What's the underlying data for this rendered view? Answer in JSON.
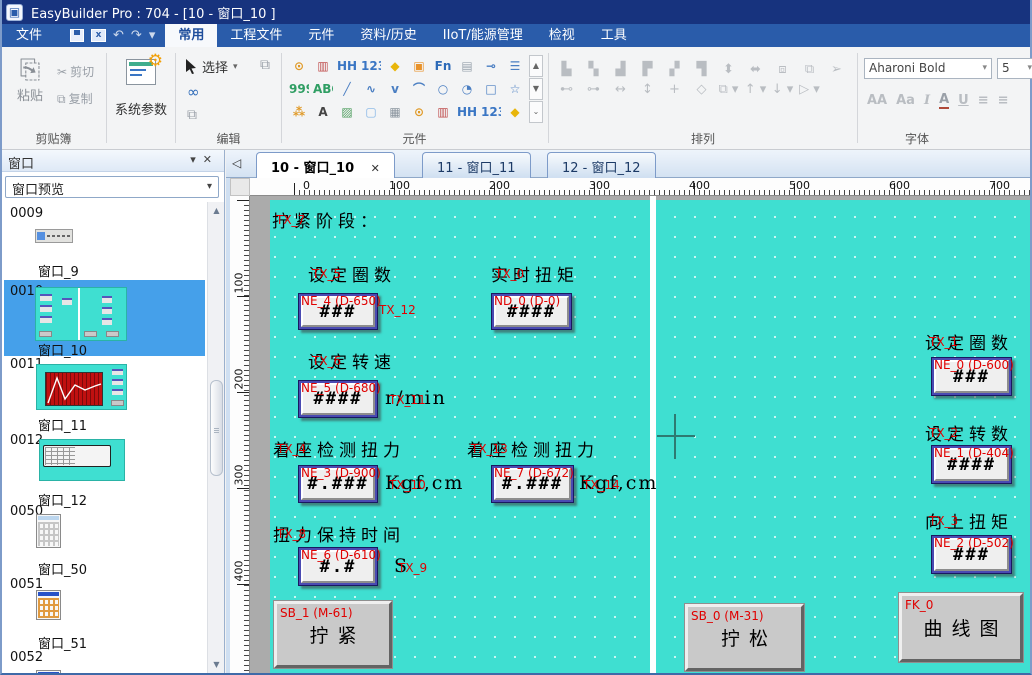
{
  "title_bar": {
    "title": "EasyBuilder Pro : 704 - [10 - 窗口_10 ]"
  },
  "menu_bar": {
    "file": "文件",
    "quick": {
      "undo": "↶",
      "redo": "↷",
      "more": "▾",
      "export_label": "x"
    },
    "tabs": [
      {
        "label": "常用"
      },
      {
        "label": "工程文件"
      },
      {
        "label": "元件"
      },
      {
        "label": "资料/历史"
      },
      {
        "label": "IIoT/能源管理"
      },
      {
        "label": "检视"
      },
      {
        "label": "工具"
      }
    ]
  },
  "ribbon": {
    "clipboard": {
      "paste": "粘贴",
      "cut": "剪切",
      "copy": "复制",
      "label": "剪贴簿",
      "paste_glyph": "⎘",
      "cut_glyph": "✂",
      "copy_glyph": "⧉"
    },
    "system_params": {
      "label": "系统参数",
      "gear_glyph": "⚙"
    },
    "edit": {
      "select": "选择",
      "label": "编辑",
      "caret": "▾",
      "infinity": "∞",
      "dup": "⧉",
      "win": "⧉"
    },
    "components": {
      "label": "元件",
      "scroll": {
        "up": "▲",
        "down": "▼",
        "more": "⌄"
      },
      "icons": [
        {
          "name": "bit-lamp-icon",
          "g": "⊙",
          "c": "#e09a28"
        },
        {
          "name": "word-lamp-icon",
          "g": "▥",
          "c": "#c05050"
        },
        {
          "name": "set-bit-icon",
          "g": "HH",
          "c": "#3a76c4"
        },
        {
          "name": "set-word-icon",
          "g": "123",
          "c": "#3a76c4"
        },
        {
          "name": "function-key-icon",
          "g": "◆",
          "c": "#e8b50a"
        },
        {
          "name": "toggle-switch-icon",
          "g": "▣",
          "c": "#e8922a"
        },
        {
          "name": "fn-key-icon",
          "g": "Fn",
          "c": "#2d6ab8"
        },
        {
          "name": "multi-state-icon",
          "g": "▤",
          "c": "#9aa4ae"
        },
        {
          "name": "slider-icon",
          "g": "⊸",
          "c": "#4a7ec2"
        },
        {
          "name": "option-list-icon",
          "g": "☰",
          "c": "#4a7ec2"
        },
        {
          "name": "numeric-999-icon",
          "g": "999",
          "c": "#2f9e63"
        },
        {
          "name": "ascii-abc-icon",
          "g": "ABC",
          "c": "#2f9e63"
        },
        {
          "name": "line-icon",
          "g": "╱",
          "c": "#4a7ec2"
        },
        {
          "name": "wave-icon",
          "g": "∿",
          "c": "#4a7ec2"
        },
        {
          "name": "polyline-icon",
          "g": "ⅴ",
          "c": "#4a7ec2"
        },
        {
          "name": "arc-icon",
          "g": "⌒",
          "c": "#4a7ec2"
        },
        {
          "name": "circle-icon",
          "g": "○",
          "c": "#4a7ec2"
        },
        {
          "name": "pie-icon",
          "g": "◔",
          "c": "#4a7ec2"
        },
        {
          "name": "rect-icon",
          "g": "□",
          "c": "#4a7ec2"
        },
        {
          "name": "star-icon",
          "g": "☆",
          "c": "#4a7ec2"
        },
        {
          "name": "spark-icon",
          "g": "⁂",
          "c": "#e09a28"
        },
        {
          "name": "text-icon",
          "g": "A",
          "c": "#444444"
        },
        {
          "name": "picture-icon",
          "g": "▨",
          "c": "#4f9e5f"
        },
        {
          "name": "frame-icon",
          "g": "▢",
          "c": "#7fb2e5"
        },
        {
          "name": "table-icon",
          "g": "▦",
          "c": "#8a949e"
        },
        {
          "name": "bit-lamp2-icon",
          "g": "⊙",
          "c": "#e09a28"
        },
        {
          "name": "word-lamp2-icon",
          "g": "▥",
          "c": "#c05050"
        },
        {
          "name": "set-bit2-icon",
          "g": "HH",
          "c": "#3a76c4"
        },
        {
          "name": "set-word2-icon",
          "g": "123",
          "c": "#3a76c4"
        },
        {
          "name": "function-key2-icon",
          "g": "◆",
          "c": "#e8b50a"
        }
      ]
    },
    "arrange": {
      "label": "排列",
      "icons": [
        {
          "name": "align-left-icon",
          "g": "▙"
        },
        {
          "name": "align-center-h-icon",
          "g": "▚"
        },
        {
          "name": "align-right-icon",
          "g": "▟"
        },
        {
          "name": "align-top-icon",
          "g": "▛"
        },
        {
          "name": "align-middle-icon",
          "g": "▞"
        },
        {
          "name": "align-bottom-icon",
          "g": "▜"
        },
        {
          "name": "fit-height-icon",
          "g": "⬍"
        },
        {
          "name": "fit-width-icon",
          "g": "⬌"
        },
        {
          "name": "group-icon",
          "g": "⧈"
        },
        {
          "name": "ungroup-icon",
          "g": "⧉"
        },
        {
          "name": "pin-icon",
          "g": "➢"
        },
        {
          "name": "distribute-h-icon",
          "g": "⊷"
        },
        {
          "name": "distribute-v-icon",
          "g": "⊶"
        },
        {
          "name": "same-width-icon",
          "g": "↔"
        },
        {
          "name": "same-height-icon",
          "g": "↕"
        },
        {
          "name": "same-size-icon",
          "g": "+"
        },
        {
          "name": "shape-icon",
          "g": "◇"
        },
        {
          "name": "bring-front-icon",
          "g": "⧉ ▾"
        },
        {
          "name": "move-up-icon",
          "g": "↑ ▾"
        },
        {
          "name": "move-down-icon",
          "g": "↓ ▾"
        },
        {
          "name": "send-back-icon",
          "g": "▷ ▾"
        }
      ]
    },
    "font": {
      "label": "字体",
      "family": "Aharoni Bold",
      "size": "5",
      "caret": "▾",
      "grow": "AA",
      "shrink": "Aa",
      "italic": "I",
      "color": "A",
      "underline": "U",
      "align_left": "≡",
      "align_center": "≡"
    }
  },
  "left_panel": {
    "title": "窗口",
    "head_caret": "▾",
    "head_close": "✕",
    "preview_selector": "窗口预览",
    "combo_caret": "▾",
    "scroll_up": "▲",
    "scroll_down": "▼",
    "items": [
      {
        "id": "0009",
        "label": "窗口_9"
      },
      {
        "id": "0010",
        "label": "窗口_10"
      },
      {
        "id": "0011",
        "label": "窗口_11"
      },
      {
        "id": "0012",
        "label": "窗口_12"
      },
      {
        "id": "0050",
        "label": "窗口_50"
      },
      {
        "id": "0051",
        "label": "窗口_51"
      },
      {
        "id": "0052",
        "label": ""
      }
    ]
  },
  "workspace": {
    "back_arrow": "◁",
    "doc_tabs": [
      {
        "label": "10 - 窗口_10",
        "close": "✕"
      },
      {
        "label": "11 - 窗口_11"
      },
      {
        "label": "12 - 窗口_12"
      }
    ],
    "hruler": [
      "0",
      "100",
      "200",
      "300",
      "400",
      "500",
      "600",
      "700"
    ],
    "vruler": [
      "100",
      "200",
      "300",
      "400"
    ]
  },
  "canvas": {
    "texts": [
      {
        "text": "拧紧阶段：",
        "tag": "TX_7"
      },
      {
        "text": "设定圈数",
        "tag": "TX_5"
      },
      {
        "text": "实时扭矩",
        "tag": "TX_0"
      },
      {
        "text": "设定转速",
        "tag": "TX_6"
      },
      {
        "text": "r/min",
        "tag": "TX_11"
      },
      {
        "text": "着座检测扭力",
        "tag": "TX_4"
      },
      {
        "text": "Kgf,cm",
        "tag": "TX_10"
      },
      {
        "text": "着座检测扭力",
        "tag": "TX_13"
      },
      {
        "text": "Kgf,cm",
        "tag": "TX_14"
      },
      {
        "text": "扭力保持时间",
        "tag": "TX_8"
      },
      {
        "text": "S",
        "tag": "TX_9"
      },
      {
        "text": "",
        "tag": "TX_12"
      },
      {
        "text": "设定圈数",
        "tag": "TX_1"
      },
      {
        "text": "设定转数",
        "tag": "TX_2"
      },
      {
        "text": "向上扭矩",
        "tag": "TX_3"
      }
    ],
    "numerics": [
      {
        "tag": "NE_4 (D-650)",
        "value": "###"
      },
      {
        "tag": "ND_0 (D-0)",
        "value": "####"
      },
      {
        "tag": "NE_5 (D-680)",
        "value": "####"
      },
      {
        "tag": "NE_3 (D-900)",
        "value": "#.###"
      },
      {
        "tag": "NE_7 (D-672)",
        "value": "#.###"
      },
      {
        "tag": "NE_6 (D-610)",
        "value": "#.#"
      },
      {
        "tag": "NE_0 (D-600)",
        "value": "###"
      },
      {
        "tag": "NE_1 (D-404)",
        "value": "####"
      },
      {
        "tag": "NE_2 (D-502)",
        "value": "###"
      }
    ],
    "buttons": [
      {
        "tag": "SB_1 (M-61)",
        "label": "拧紧"
      },
      {
        "tag": "SB_0 (M-31)",
        "label": "拧松"
      },
      {
        "tag": "FK_0",
        "label": "曲线图"
      }
    ]
  },
  "colors": {
    "canvas_teal": "#3fdfd1",
    "tag_red": "#e00000",
    "selection_blue": "#45a0ea",
    "titlebar": "#17337e",
    "menubar": "#2a5caa"
  }
}
